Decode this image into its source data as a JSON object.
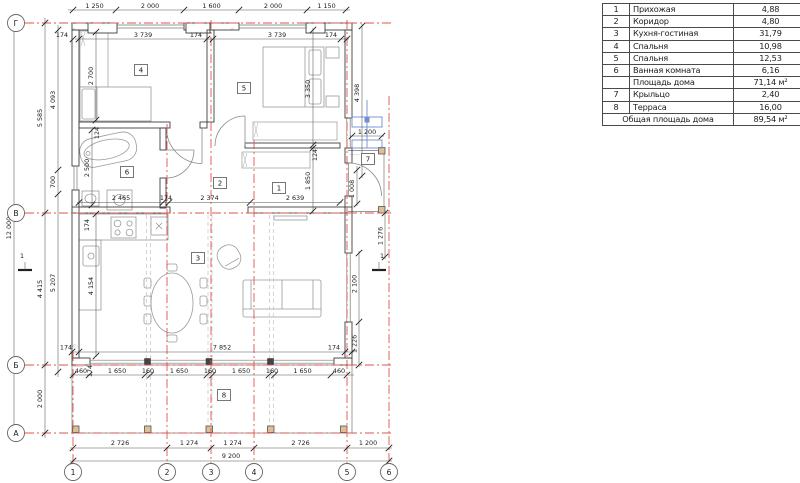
{
  "table": {
    "rows": [
      {
        "num": "1",
        "name": "Прихожая",
        "value": "4,88"
      },
      {
        "num": "2",
        "name": "Коридор",
        "value": "4,80"
      },
      {
        "num": "3",
        "name": "Кухня-гостиная",
        "value": "31,79"
      },
      {
        "num": "4",
        "name": "Спальня",
        "value": "10,98"
      },
      {
        "num": "5",
        "name": "Спальня",
        "value": "12,53"
      },
      {
        "num": "6",
        "name": "Ванная комната",
        "value": "6,16"
      },
      {
        "num": "",
        "name": "Площадь дома",
        "value": "71,14 м²"
      },
      {
        "num": "7",
        "name": "Крыльцо",
        "value": "2,40"
      },
      {
        "num": "8",
        "name": "Терраса",
        "value": "16,00"
      }
    ],
    "total_label": "Общая площадь дома",
    "total_value": "89,54 м²"
  },
  "axes": {
    "rows": [
      "Г",
      "В",
      "Б",
      "А"
    ],
    "cols": [
      "1",
      "2",
      "3",
      "4",
      "5",
      "6"
    ]
  },
  "rooms": {
    "labels": [
      "1",
      "2",
      "3",
      "4",
      "5",
      "6",
      "7",
      "8"
    ]
  },
  "section_marks": {
    "left": "1",
    "right": "1"
  },
  "dims": {
    "top_outer": [
      "1 250",
      "2 000",
      "1 600",
      "2 000",
      "1 150"
    ],
    "top_inner": [
      "174",
      "3 739",
      "174",
      "3 739",
      "174"
    ],
    "left_total": "12 000",
    "left_seg": [
      "5 585",
      "4 415",
      "2 000"
    ],
    "left_inner": [
      "4 093",
      "700",
      "5 207"
    ],
    "v2700": "2 700",
    "v124a": "124",
    "v2500": "2 500",
    "v3350": "3 350",
    "v124b": "124",
    "v1850": "1 850",
    "v4154": "4 154",
    "v174k": "174",
    "mid": [
      "2 465",
      "174",
      "2 374",
      "2 639"
    ],
    "right_v4398": "4 398",
    "right_h1200": "1 200",
    "right_v1008": "1 008",
    "right_v1276": "1 276",
    "right_v2100": "2 100",
    "right_v1226": "1 226",
    "w7852": "7 852",
    "t174l": "174",
    "t174r": "174",
    "terrace_row": [
      "460",
      "174",
      "1 650",
      "160",
      "1 650",
      "160",
      "1 650",
      "160",
      "1 650",
      "460"
    ],
    "bottom_row": [
      "2 726",
      "1 274",
      "1 274",
      "2 726",
      "1 200"
    ],
    "bottom_total": "9 200"
  },
  "colors": {
    "axis_red": "#e0564e",
    "wall": "#3d3d3d",
    "window_blue": "#6f8fd0",
    "post_tan": "#dcbf96"
  }
}
